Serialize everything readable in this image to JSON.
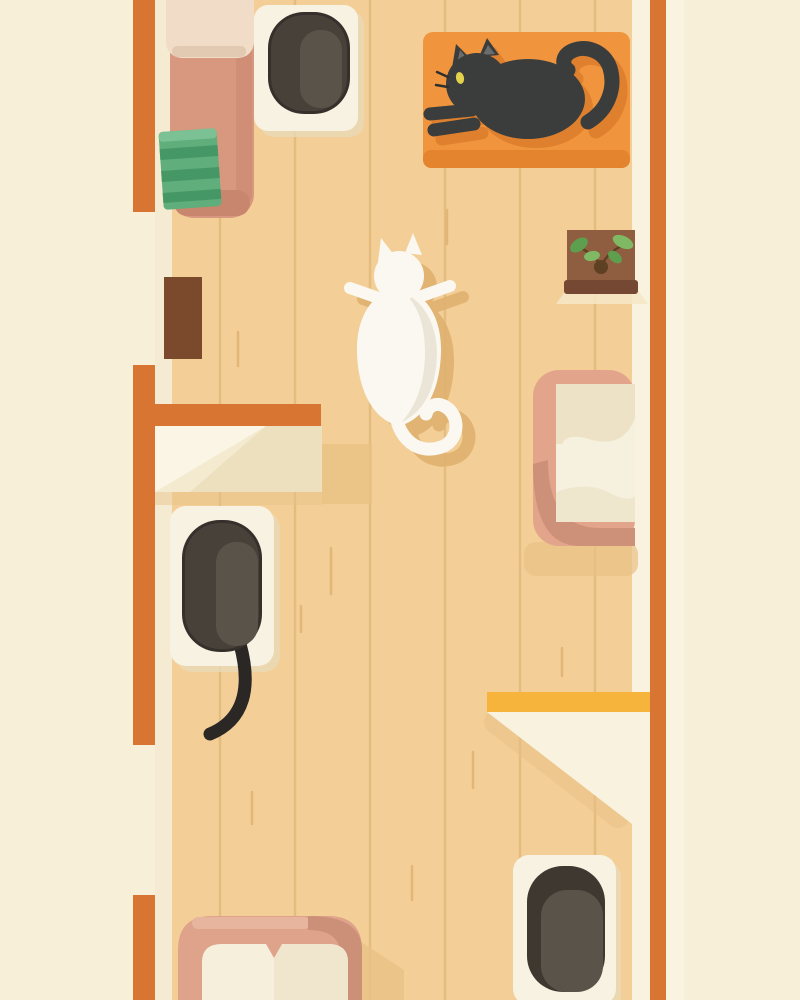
{
  "scene": {
    "description": "Top-down flat illustration of a narrow wooden-floored cat room: a black cat lounges on an orange rug, a white cat sprawls mid-floor, a dark cat sleeps on a white mat, with pink pet beds, green towels, shelves, a brown door mat and a potted plant, framed by orange walls.",
    "objects": [
      "orange-walls",
      "wood-floor",
      "pet-bed-top-left",
      "green-towels",
      "litter-mat-top",
      "orange-rug",
      "black-cat",
      "potted-plant",
      "door-mat-brown",
      "wall-shelf-cream",
      "white-cat",
      "sleeping-dark-cat",
      "litter-mat-left",
      "pet-bed-right",
      "wall-shelf-yellow",
      "litter-mat-bottom",
      "pet-bed-bottom"
    ]
  },
  "colors": {
    "background": "#F7EFD7",
    "outer_wall_strip": "#FAF3E0",
    "floor": "#F3CF97",
    "plank_line": "#D9AD6D",
    "grain": "#DCA96A",
    "inner_edge_left": "#F4EBD2",
    "inner_edge_right": "#F8F2DF",
    "wall_orange": "#D87532",
    "bed_pink": "#D8987F",
    "bed_pink_dark": "#C8866E",
    "bed_cushion_light": "#F0DCC7",
    "cushion_fold": "#DFC5AD",
    "towel_green": "#5FAE7B",
    "towel_green_dark": "#459865",
    "towel_green_light": "#7CC194",
    "mat_white": "#F8F2E2",
    "mat_shadow": "#E9D9B6",
    "litter_outline": "#35302B",
    "litter_dark": "#47413A",
    "litter_mid": "#5A5349",
    "litter_darker": "#3E3831",
    "rug_orange": "#F0953D",
    "rug_shadow": "#E5842F",
    "cat_black": "#3B3D3C",
    "cat_black_shadow": "#DD7E2D",
    "cat_ear_inner": "#6B6D6C",
    "cat_eye": "#E2D24C",
    "cat_whisker": "#2E302F",
    "shelf_light": "#F5E8C5",
    "planter_brown": "#8F5D3F",
    "planter_rim": "#744832",
    "stem_brown": "#5E4022",
    "leaf_green": "#5E9E4F",
    "leaf_green_light": "#7FB964",
    "door_mat_brown": "#7B4A2C",
    "shelf_cream": "#F3EACF",
    "shelf_bright": "#FBF5E6",
    "shelf_shade": "#EDE0BF",
    "floor_shadow": "#E8C085",
    "cat_white": "#FBF8F1",
    "cat_white_shade": "#EAE5D7",
    "white_cat_floor_shadow": "#E0B271",
    "dark_cat_tail": "#2B2724",
    "bed2_pink": "#E2A58B",
    "bed2_pink_dark": "#CD9078",
    "bed2_cushion": "#F6F0DE",
    "bed2_pillow": "#EDE2C6",
    "shelf_yellow": "#F6B43D",
    "bed3_pink": "#DFA28B",
    "bed3_pink_dark": "#CC9078",
    "bed3_pink_light": "#E7B49E",
    "bed3_cushion": "#F6EFDC",
    "bed3_pillow": "#F0E6CE"
  }
}
